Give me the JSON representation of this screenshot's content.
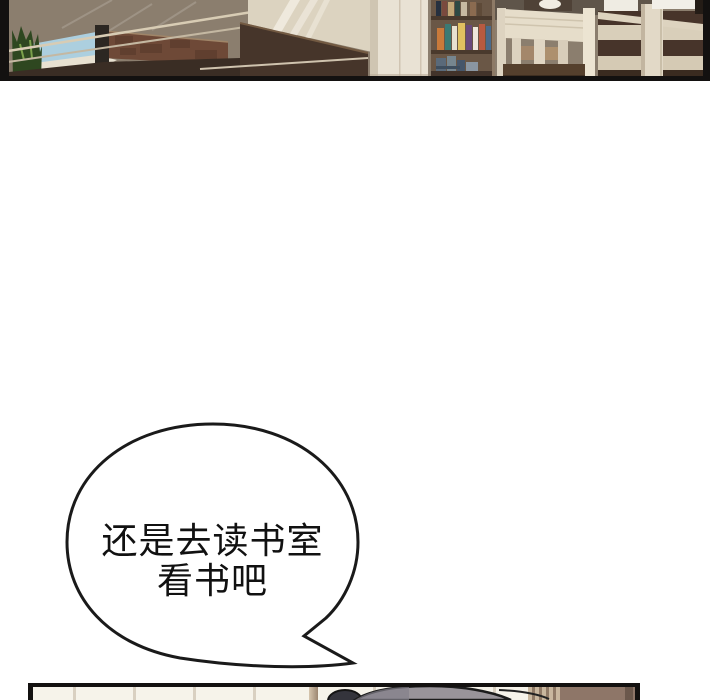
{
  "page": {
    "width": 720,
    "height": 700,
    "type": "webtoon comic page"
  },
  "panels": {
    "top": {
      "label": "library interior panel (cropped): plant, window, railing, brick ledge, desk, bookshelf, wooden chairs"
    },
    "bottom": {
      "label": "room panel (cropped): paneled wall, top of gray head, wooden door"
    }
  },
  "speech_bubble": {
    "lines": [
      "还是去读书室",
      "看书吧"
    ],
    "full_text": "还是去读书室 看书吧"
  },
  "colors": {
    "page_bg": "#ffffff",
    "panel_border": "#131110",
    "bubble_stroke": "#1a1a1a",
    "bubble_fill": "#ffffff",
    "speech_text": "#111111",
    "wall_gray_brown": "#8b7e6e",
    "wall_cream": "#dcd3c0",
    "wood_dark": "#46352a",
    "wood_mid": "#6e4937",
    "sky_blue": "#accfdf",
    "plant_green": "#2e4720",
    "plant_green_light": "#7ba14b",
    "shelf_brown": "#6a5746",
    "chair_cream": "#e2d9c7",
    "slat_brown": "#47342a",
    "column_white": "#e9e2d4",
    "sill_white": "#e8e1d1",
    "room_cream": "#f6f3ea",
    "head_gray": "#99949a"
  }
}
